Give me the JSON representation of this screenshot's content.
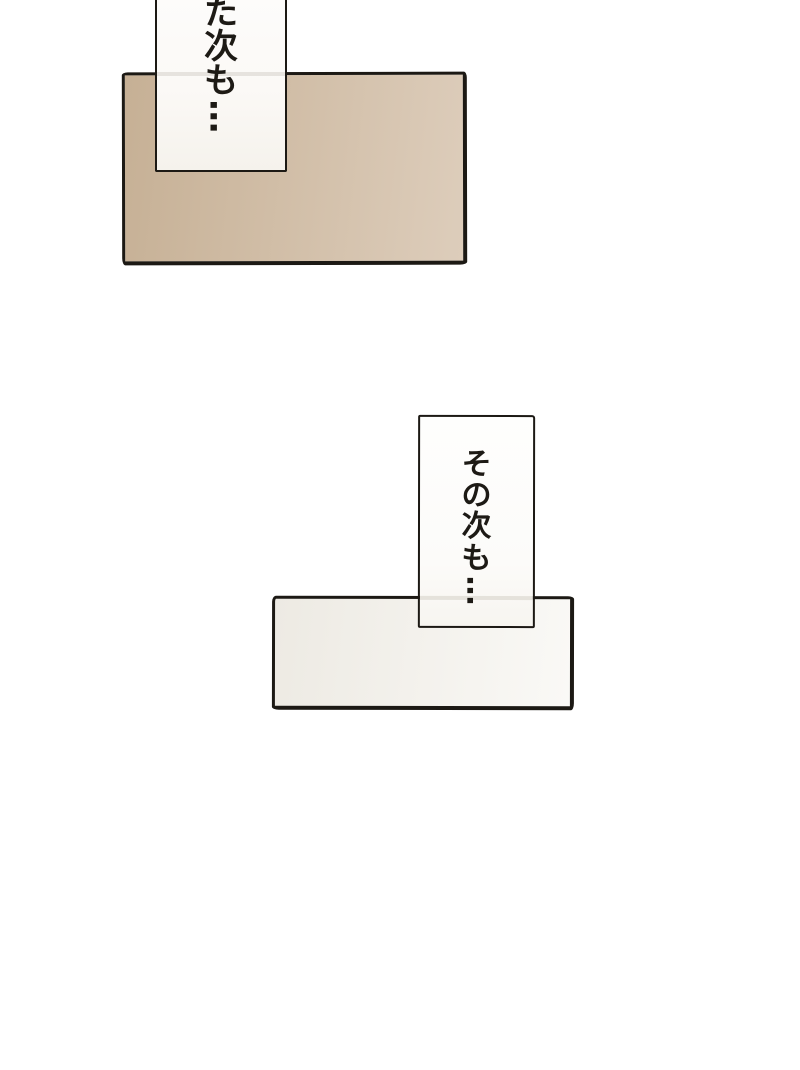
{
  "page": {
    "kind": "manga-page-fragment",
    "background": "#ffffff",
    "ink_color": "#1c1914"
  },
  "panels": [
    {
      "id": "panel-top",
      "fill_left": "#c6b095",
      "fill_right": "#ddcdbb"
    },
    {
      "id": "panel-bottom",
      "fill_left": "#edeae3",
      "fill_right": "#faf9f6"
    }
  ],
  "bubbles": [
    {
      "id": "speech-box-top",
      "text": "た次も…",
      "writing": "vertical",
      "clipped_top": true
    },
    {
      "id": "speech-box-bottom",
      "text": "その次も…",
      "writing": "vertical",
      "clipped_top": false
    }
  ]
}
